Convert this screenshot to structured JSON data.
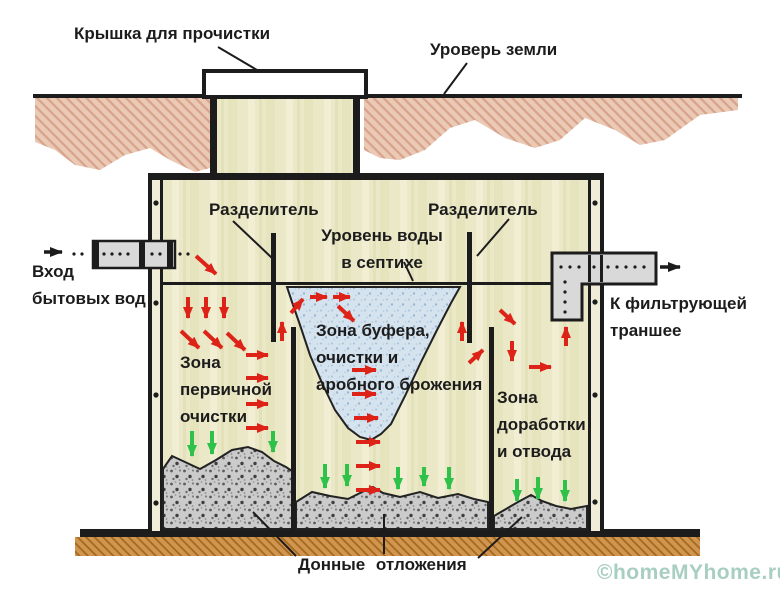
{
  "labels": {
    "lid_cover": "Крышка для прочистки",
    "ground_level": "Уроверь земли",
    "divider_left": "Разделитель",
    "divider_right": "Разделитель",
    "water_level": {
      "line1": "Уровень воды",
      "line2": "в септихе"
    },
    "inlet": {
      "line1": "Вход",
      "line2": "бытовых вод"
    },
    "outlet": {
      "line1": "К фильтрующей",
      "line2": "траншее"
    },
    "zone_primary": {
      "line1": "Зона",
      "line2": "первичной",
      "line3": "очистки"
    },
    "zone_buffer": {
      "line1": "Зона буфера,",
      "line2": "очистки и",
      "line3": "аробного брожения"
    },
    "zone_final": {
      "line1": "Зона",
      "line2": "доработки",
      "line3": "и отвода"
    },
    "bottom_sediment": "Донные отложения"
  },
  "watermark": "©homeMYhome.ru",
  "icons": {
    "inlet_flow_arrow": "black-right-arrow",
    "outlet_flow_arrow": "black-right-arrow",
    "red_flow_arrows": "red-directional-flow-arrows",
    "green_seep_arrows": "green-down-seep-arrows"
  },
  "colors": {
    "line_black": "#1c1c1c",
    "soil": "#eac9b5",
    "soil_hatch": "#d8a28b",
    "tank_fill": "#ebe8c7",
    "water_fill": "#d5e3ef",
    "sediment_fill": "#cbcbcb",
    "base_fill": "#d2954f",
    "base_hatch": "#a26a20",
    "pipe_fill": "#d9d9d9",
    "arrow_red": "#dd2318",
    "arrow_green": "#2ec24a",
    "watermark": "#a8cec2",
    "text": "#1c1c1c"
  }
}
